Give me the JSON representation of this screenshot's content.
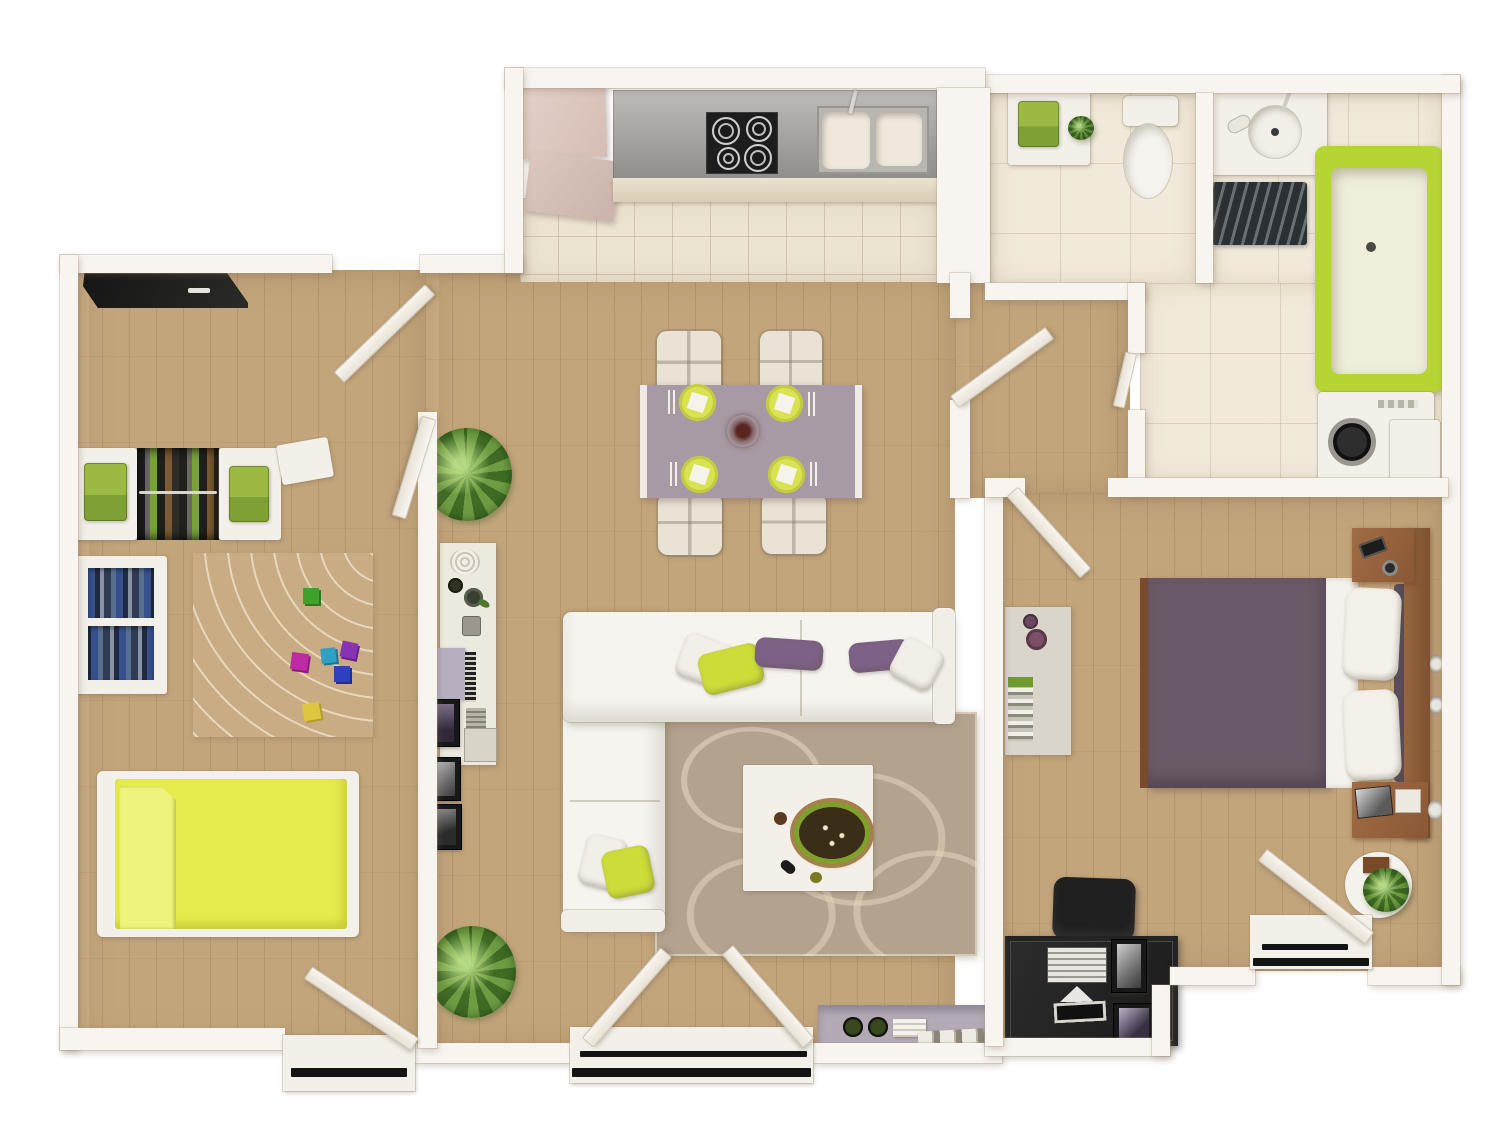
{
  "scene": {
    "type": "3d-floor-plan-top-view",
    "description": "Top-down 3D render of a two-bedroom apartment floor plan with lime green and purple accents",
    "rooms": [
      {
        "name": "Kitchen",
        "furniture": [
          "tall cabinet",
          "counter",
          "cooktop with four burners",
          "double sink with faucet",
          "tiled floor"
        ]
      },
      {
        "name": "Kids bedroom",
        "furniture": [
          "dark wall panel",
          "open wardrobe with hanging clothes",
          "two towel cabinets",
          "bookshelf",
          "arc-patterned rug",
          "six colored toy cubes",
          "bed with lime bedding",
          "balcony door with threshold"
        ]
      },
      {
        "name": "Living and dining room",
        "furniture": [
          "dining table with four place settings",
          "four cream chairs",
          "centerpiece",
          "L-shaped white sectional sofa",
          "seven throw pillows",
          "circle-patterned area rug",
          "white coffee table with snack bowl",
          "display console with vases and magazines",
          "two potted plants",
          "lavender sideboard",
          "double balcony doors"
        ]
      },
      {
        "name": "Hallway",
        "furniture": [
          "door to living room",
          "door to master bedroom",
          "door to bathroom"
        ]
      },
      {
        "name": "WC",
        "furniture": [
          "towel cabinet with plant",
          "toilet"
        ]
      },
      {
        "name": "Bathroom",
        "furniture": [
          "vanity with round basin",
          "zebra bath mat",
          "lime bathtub",
          "washing machine",
          "side cabinet"
        ]
      },
      {
        "name": "Master bedroom",
        "furniture": [
          "double bed with plum duvet",
          "two white pillows",
          "wood headboard",
          "two nightstands with phone, clock and magazines",
          "wall console with vases and books",
          "black computer desk with keyboard and tablet",
          "black desk chair",
          "round side table with plant",
          "balcony door with threshold"
        ]
      }
    ],
    "palette": {
      "wood": "#c9aa80",
      "tile": "#ece3d1",
      "bathtile": "#f1e9da",
      "wall": "#f8f5f0",
      "lime": "#e6ec4d",
      "limefold": "#edf37c",
      "tublime": "#b6d433",
      "plate": "#d9e352",
      "pillowlime": "#ccdd3a",
      "purple": "#6b5a67",
      "pillowpurple": "#7d6187",
      "mauve": "#a89aa4",
      "sofa": "#f6f4ef",
      "rugliv": "#b3a28e",
      "rugkids": "#c9ac83",
      "plantdark": "#3f6b24",
      "plantlight": "#6f9c42",
      "towel": "#9cb944",
      "counter": "#a6a5a2",
      "steel": "#b7b6b0",
      "black": "#222222",
      "brown": "#98663f",
      "lavender": "#b3aab5",
      "cream": "#efe9dd"
    }
  }
}
